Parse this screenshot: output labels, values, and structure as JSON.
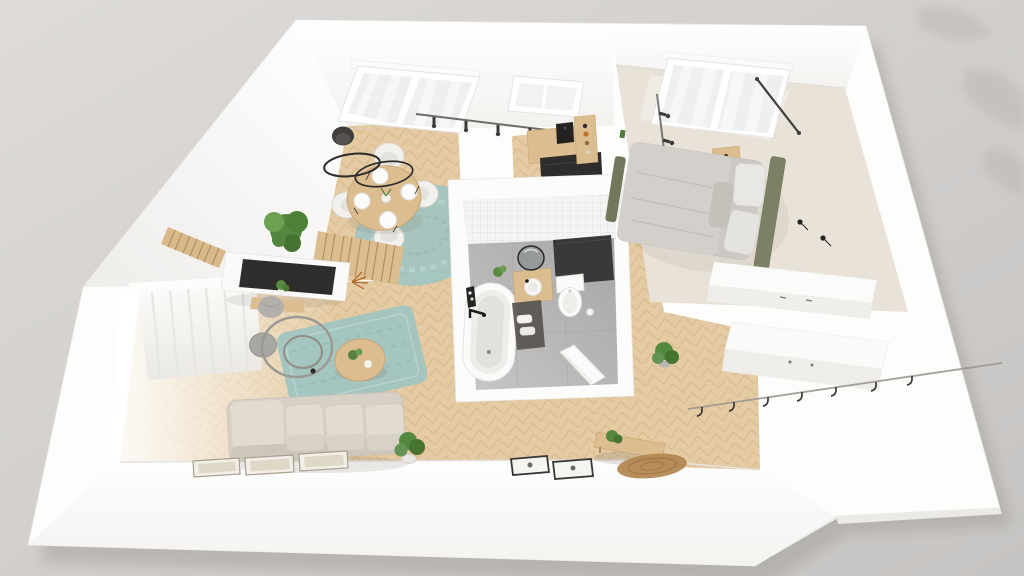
{
  "scene": {
    "view": "isometric-top-down-dollhouse-render",
    "subject": "one-bedroom-apartment-3d-floor-plan",
    "palette": {
      "background": "#d7d4d1",
      "wall": "#fdfdfc",
      "wall_shade": "#f2f0ed",
      "wood_floor": "#e5cba3",
      "wood_floor_line": "#d2b284",
      "bedroom_floor": "#e9e2d8",
      "bath_tile_wall": "#f5f4f2",
      "bath_floor": "#b4b2b0",
      "rug_teal": "#a2c4c0",
      "rug_jute": "#b2854e",
      "sofa_beige": "#d6d0c6",
      "cushion_beige": "#e1dbd1",
      "headboard_green": "#7c8166",
      "bedding_grey": "#ccc9c4",
      "pillow_white": "#e9e7e3",
      "wood_furniture": "#dcbd90",
      "appliance_dark": "#2f2d2b",
      "cabinet_dark": "#3b3937",
      "plant_green": "#55883f",
      "metal_grey": "#9a988f",
      "black_accent": "#2e2d2b",
      "mirror_grey": "#96999a",
      "curtain_white": "#fcfcfb"
    },
    "rooms": [
      {
        "id": "living-room",
        "items": [
          "sofa",
          "chaise",
          "teal-area-rug",
          "round-coffee-table",
          "ring-floor-lamp",
          "tv-console",
          "tv",
          "slat-panels",
          "floating-shelf",
          "pouf",
          "large-plant",
          "dried-flowers",
          "picture-frames",
          "window-with-sheer-curtain",
          "potted-plant"
        ]
      },
      {
        "id": "dining-area",
        "items": [
          "round-dining-table",
          "dining-chairs",
          "place-settings",
          "round-teal-rug",
          "ring-pendant-light",
          "ceiling-dome-light",
          "window-with-sheer-curtain",
          "track-lighting"
        ]
      },
      {
        "id": "kitchen",
        "items": [
          "wood-counter",
          "dark-appliance-block",
          "coffee-machine",
          "open-shelf-unit",
          "skylight-window"
        ]
      },
      {
        "id": "bathroom",
        "items": [
          "freestanding-bathtub",
          "black-floor-faucet",
          "wood-vanity",
          "round-basin",
          "round-mirror",
          "tall-dark-cabinet",
          "toilet",
          "toilet-paper-holder",
          "dark-bath-mat",
          "rolled-towels",
          "plant",
          "open-door",
          "tiled-wall"
        ]
      },
      {
        "id": "bedroom",
        "items": [
          "double-bed",
          "green-headboard",
          "grey-duvet",
          "pillows",
          "green-foot-bench",
          "nightstand",
          "window-with-sheer-curtain",
          "dark-curtain-rod",
          "track-lighting",
          "wall-reading-lights",
          "white-wardrobe"
        ]
      },
      {
        "id": "hallway",
        "items": [
          "white-wardrobe",
          "wood-bench",
          "plant",
          "round-jute-rug",
          "coat-rail-with-hooks",
          "doormats"
        ]
      }
    ],
    "counts": {
      "dining_chairs": 4,
      "dining_plates": 4,
      "sofa_seat_cushions": 3,
      "picture_frames": 3,
      "doormats": 2,
      "track_spots_dining": 5,
      "track_spots_bedroom": 5,
      "coat_hooks": 7
    }
  }
}
